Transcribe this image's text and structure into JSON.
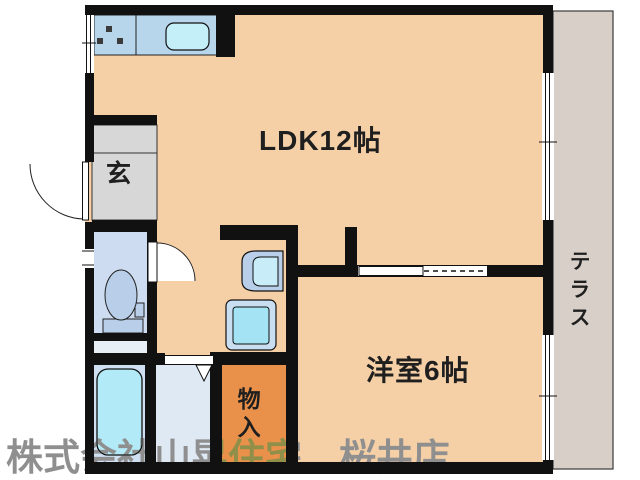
{
  "floor_plan": {
    "rooms": {
      "ldk": {
        "label": "LDK12帖"
      },
      "western_room": {
        "label": "洋室6帖"
      },
      "entrance": {
        "label": "玄"
      },
      "storage": {
        "label": "物入"
      },
      "terrace": {
        "label": "テラス"
      }
    },
    "watermark": "株式会社山晃住宅　桜井店",
    "colors": {
      "floor": "#f5cfa6",
      "terrace": "#d8d0c8",
      "entrance": "#d7d7d7",
      "toilet_room": "#cddcf0",
      "toilet_bath_gap": "#e8eef6",
      "bathroom": "#cfe0f2",
      "washroom": "#dfe9f4",
      "storage": "#e9914a",
      "kitchen_counter": "#b7d5eb",
      "sink": "#c4eef8",
      "bathtub": "#b2ebf7",
      "fixture_blue": "#b9cfe9",
      "washer_outer": "#c9def0",
      "washer_inner": "#a3e3f3",
      "basin_bowl": "#c8ecf8",
      "burner": "#3b3b3b",
      "wall": "#111111"
    }
  }
}
